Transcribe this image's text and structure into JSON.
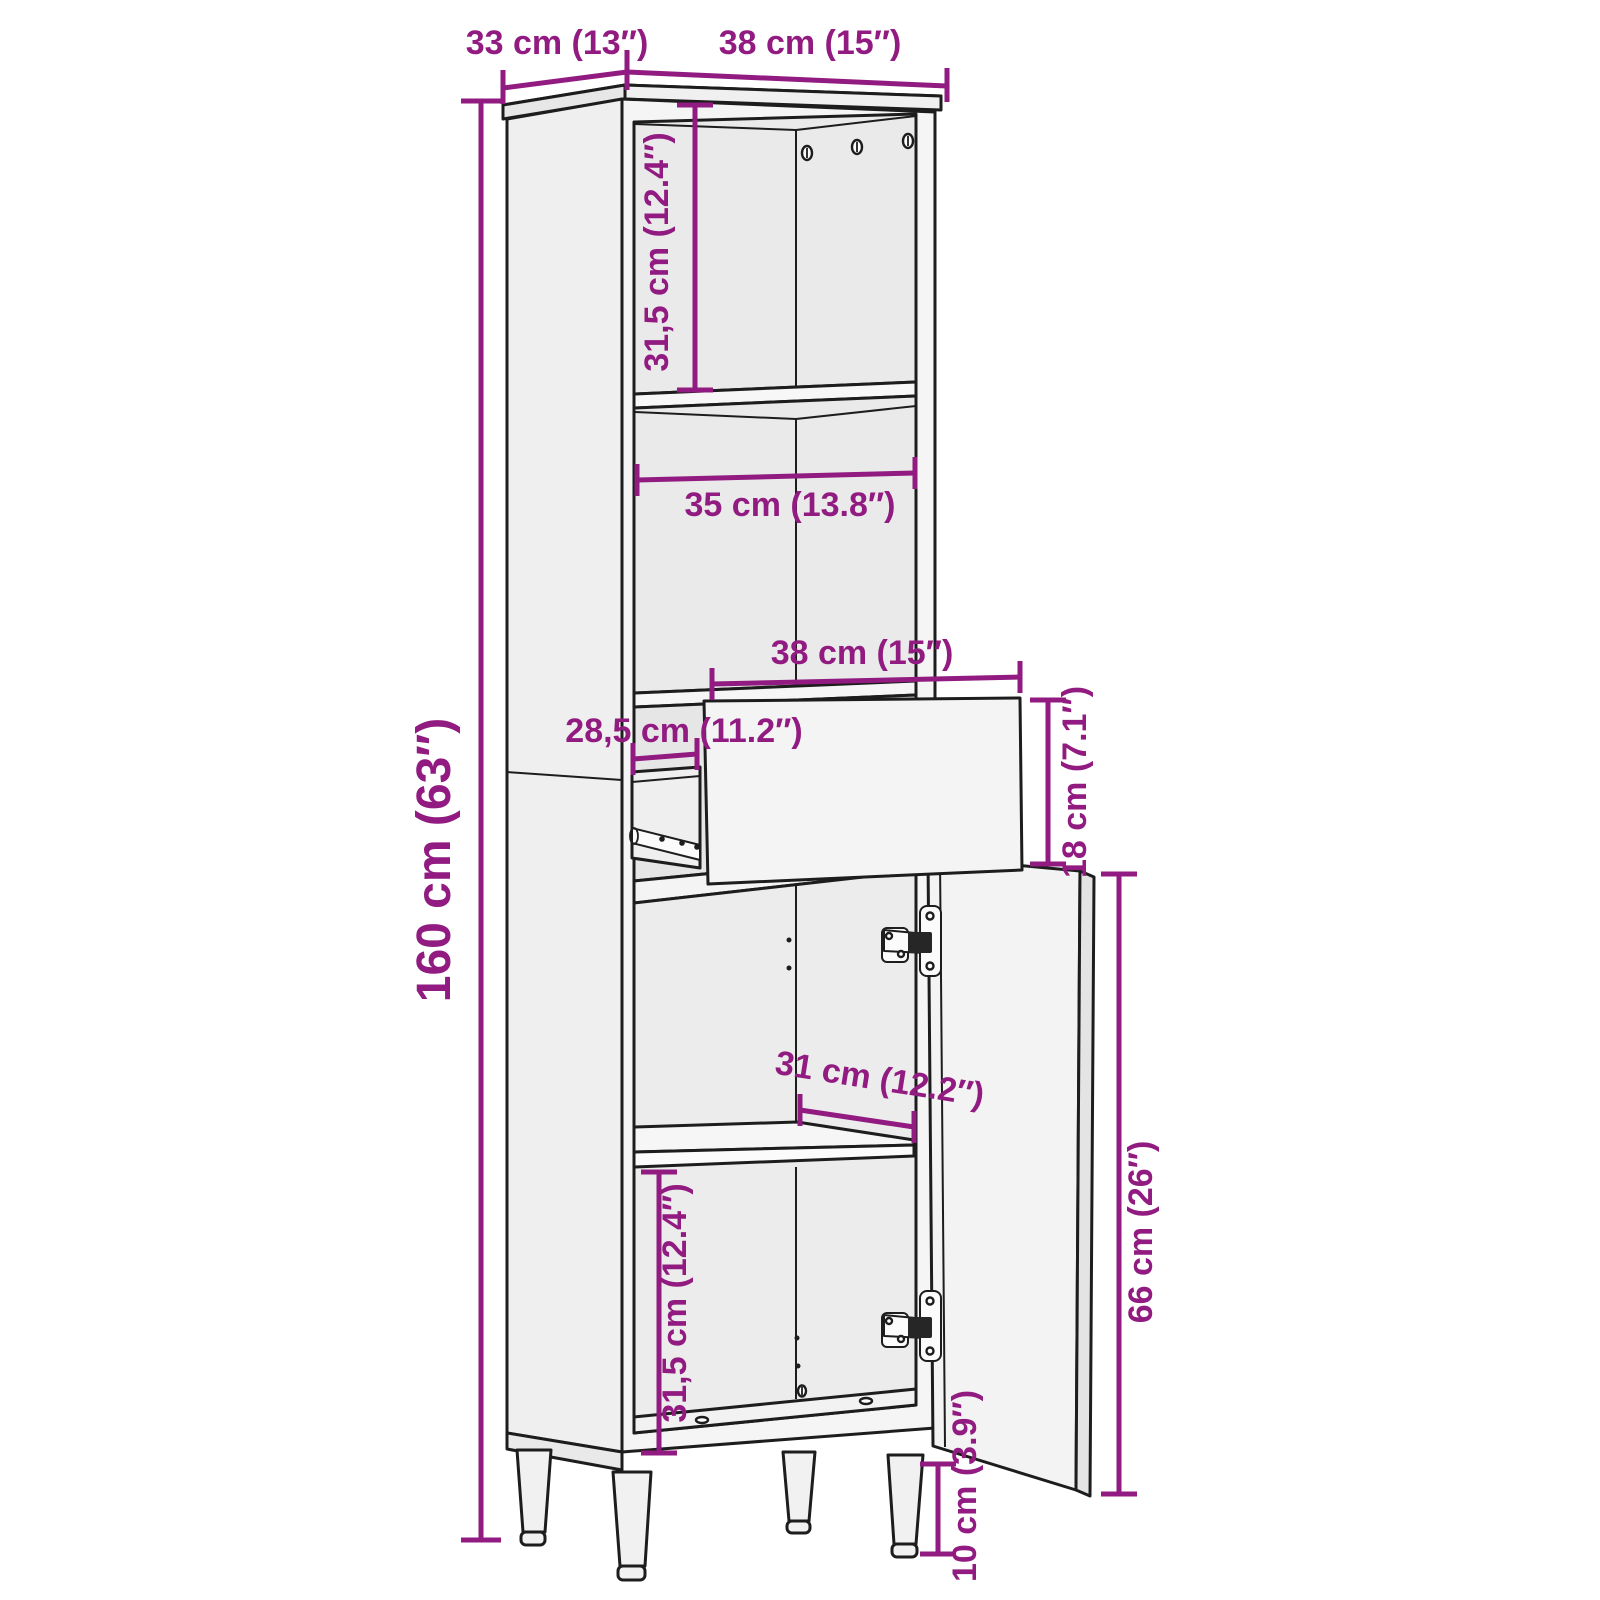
{
  "diagram": {
    "type": "furniture-dimension-diagram",
    "subject": "tall bathroom cabinet with open drawer and open door",
    "colors": {
      "accent": "#911b80",
      "line": "#1d1d1d",
      "panel_fill": "#f4f4f4",
      "background": "#ffffff"
    },
    "dimensions": {
      "top_depth": {
        "label": "33 cm (13″)"
      },
      "top_width": {
        "label": "38 cm (15″)"
      },
      "upper_compartment_height": {
        "label": "31,5 cm (12.4″)"
      },
      "inner_width": {
        "label": "35 cm (13.8″)"
      },
      "drawer_width": {
        "label": "38 cm (15″)"
      },
      "drawer_depth": {
        "label": "28,5 cm (11.2″)"
      },
      "drawer_height": {
        "label": "18 cm (7.1″)"
      },
      "total_height": {
        "label": "160 cm (63″)"
      },
      "shelf_depth": {
        "label": "31 cm (12.2″)"
      },
      "lower_compartment_height": {
        "label": "31,5 cm (12.4″)"
      },
      "door_height": {
        "label": "66 cm (26″)"
      },
      "leg_height": {
        "label": "10 cm (3.9″)"
      }
    }
  }
}
